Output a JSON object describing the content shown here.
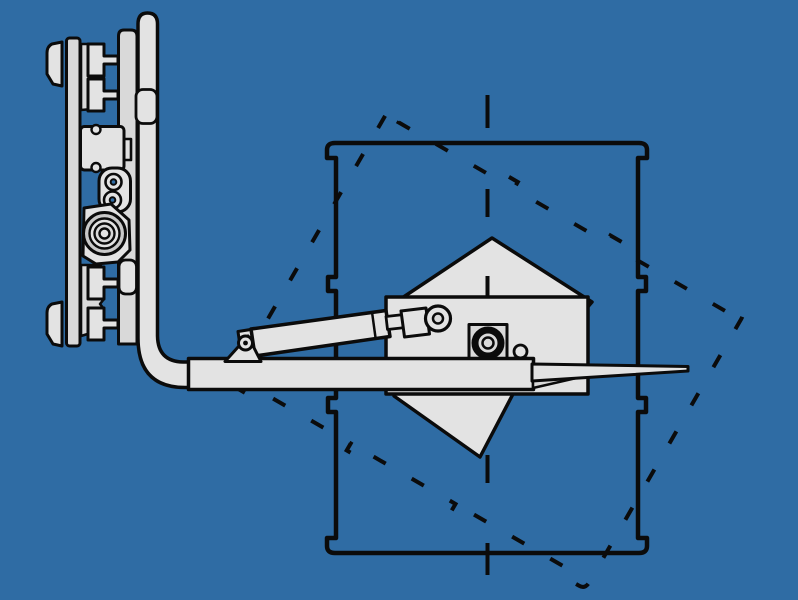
{
  "illustration": {
    "colors": {
      "background": "#2f6ca4",
      "outline": "#0b0b0b",
      "fill_light": "#e3e3e3",
      "fill_mid": "#d9d9d9",
      "fill_dark": "#c9c9c9"
    }
  }
}
